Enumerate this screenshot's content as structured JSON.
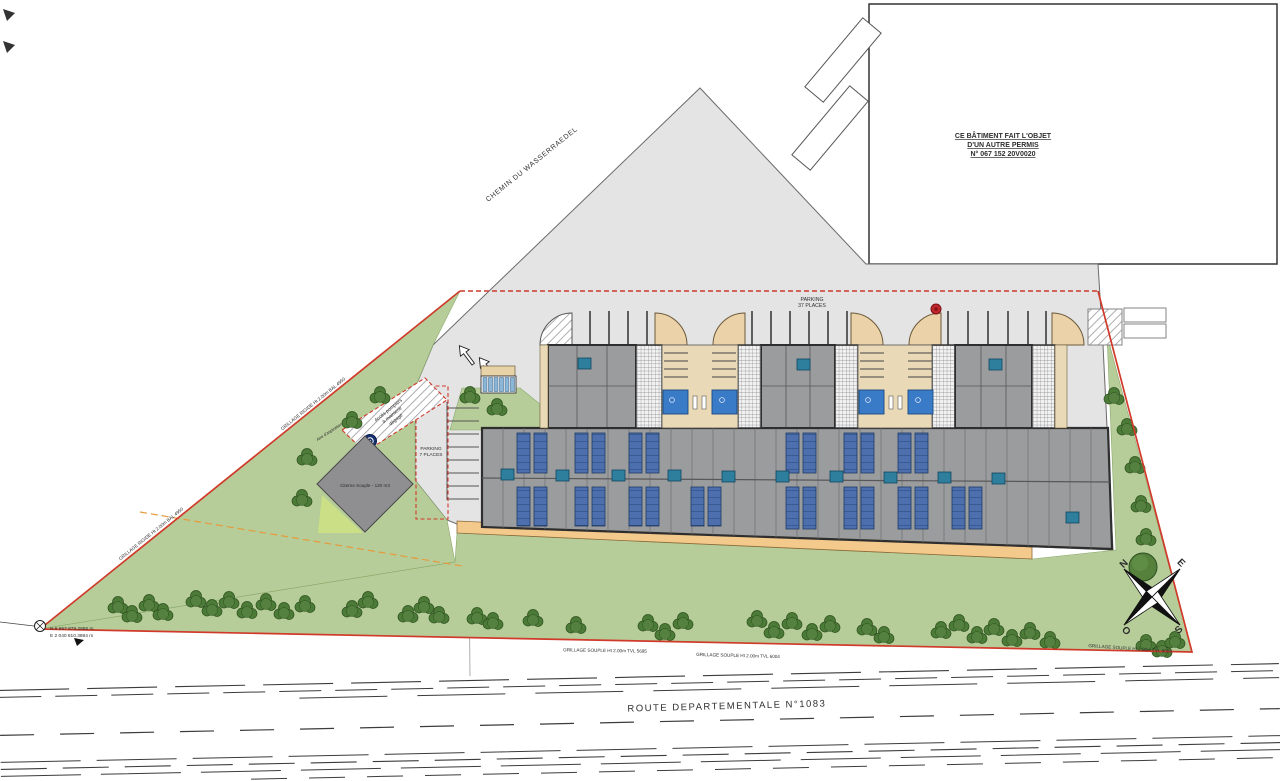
{
  "plan_title": "Plan de masse",
  "labels": {
    "chemin": "CHEMIN DU WASSERRAEDEL",
    "route": "ROUTE DEPARTEMENTALE N°1083",
    "permit1": "CE BÂTIMENT FAIT L'OBJET",
    "permit2": "D'UN AUTRE PERMIS",
    "permit3": "N° 067 152 20V0020",
    "parking_main1": "PARKING",
    "parking_main2": "37 PLACES",
    "parking_west1": "PARKING",
    "parking_west2": "7 PLACES",
    "cistern": "Citerne Souple - 120 m3",
    "fire1": "Accès pompiers",
    "fire2": "à maintenir",
    "fire3": "dégagé",
    "aspiration": "Aire d'aspiration",
    "coord_n": "N 6 857 879.2886 m",
    "coord_e": "E 2 040 810.3884 m",
    "fence_rigide_1": "GRILLAGE RIGIDE Ht 2.00m BAL 4950",
    "fence_rigide_2": "GRILLAGE RIGIDE Ht 2.00m BAL 4950",
    "fence_souple_1": "GRILLAGE SOUPLE Ht 2.00m TVL 5695",
    "fence_souple_2": "GRILLAGE SOUPLE Ht 2.00m TVL 6004",
    "fence_souple_3": "GRILLAGE SOUPLE Ht 2.00m TVL 6004"
  },
  "compass": {
    "n": "N",
    "e": "E",
    "s": "S",
    "o": "O"
  },
  "colors": {
    "boundary_red": "#d03a2a",
    "green_area": "#b7cd99",
    "tree_green": "#4c7a37",
    "paved_gray": "#e4e4e5",
    "roof_gray": "#9b9c9e",
    "solar_blue": "#4d6fae",
    "rooflight_teal": "#2e7f9e",
    "courtyard_tan": "#ead9b6",
    "walkway_sand": "#f4c98c",
    "door_blue": "#3a7bc8",
    "hydrant_red": "#c0272d",
    "marker_navy": "#16306e",
    "utility_orange": "#e59a3c"
  }
}
